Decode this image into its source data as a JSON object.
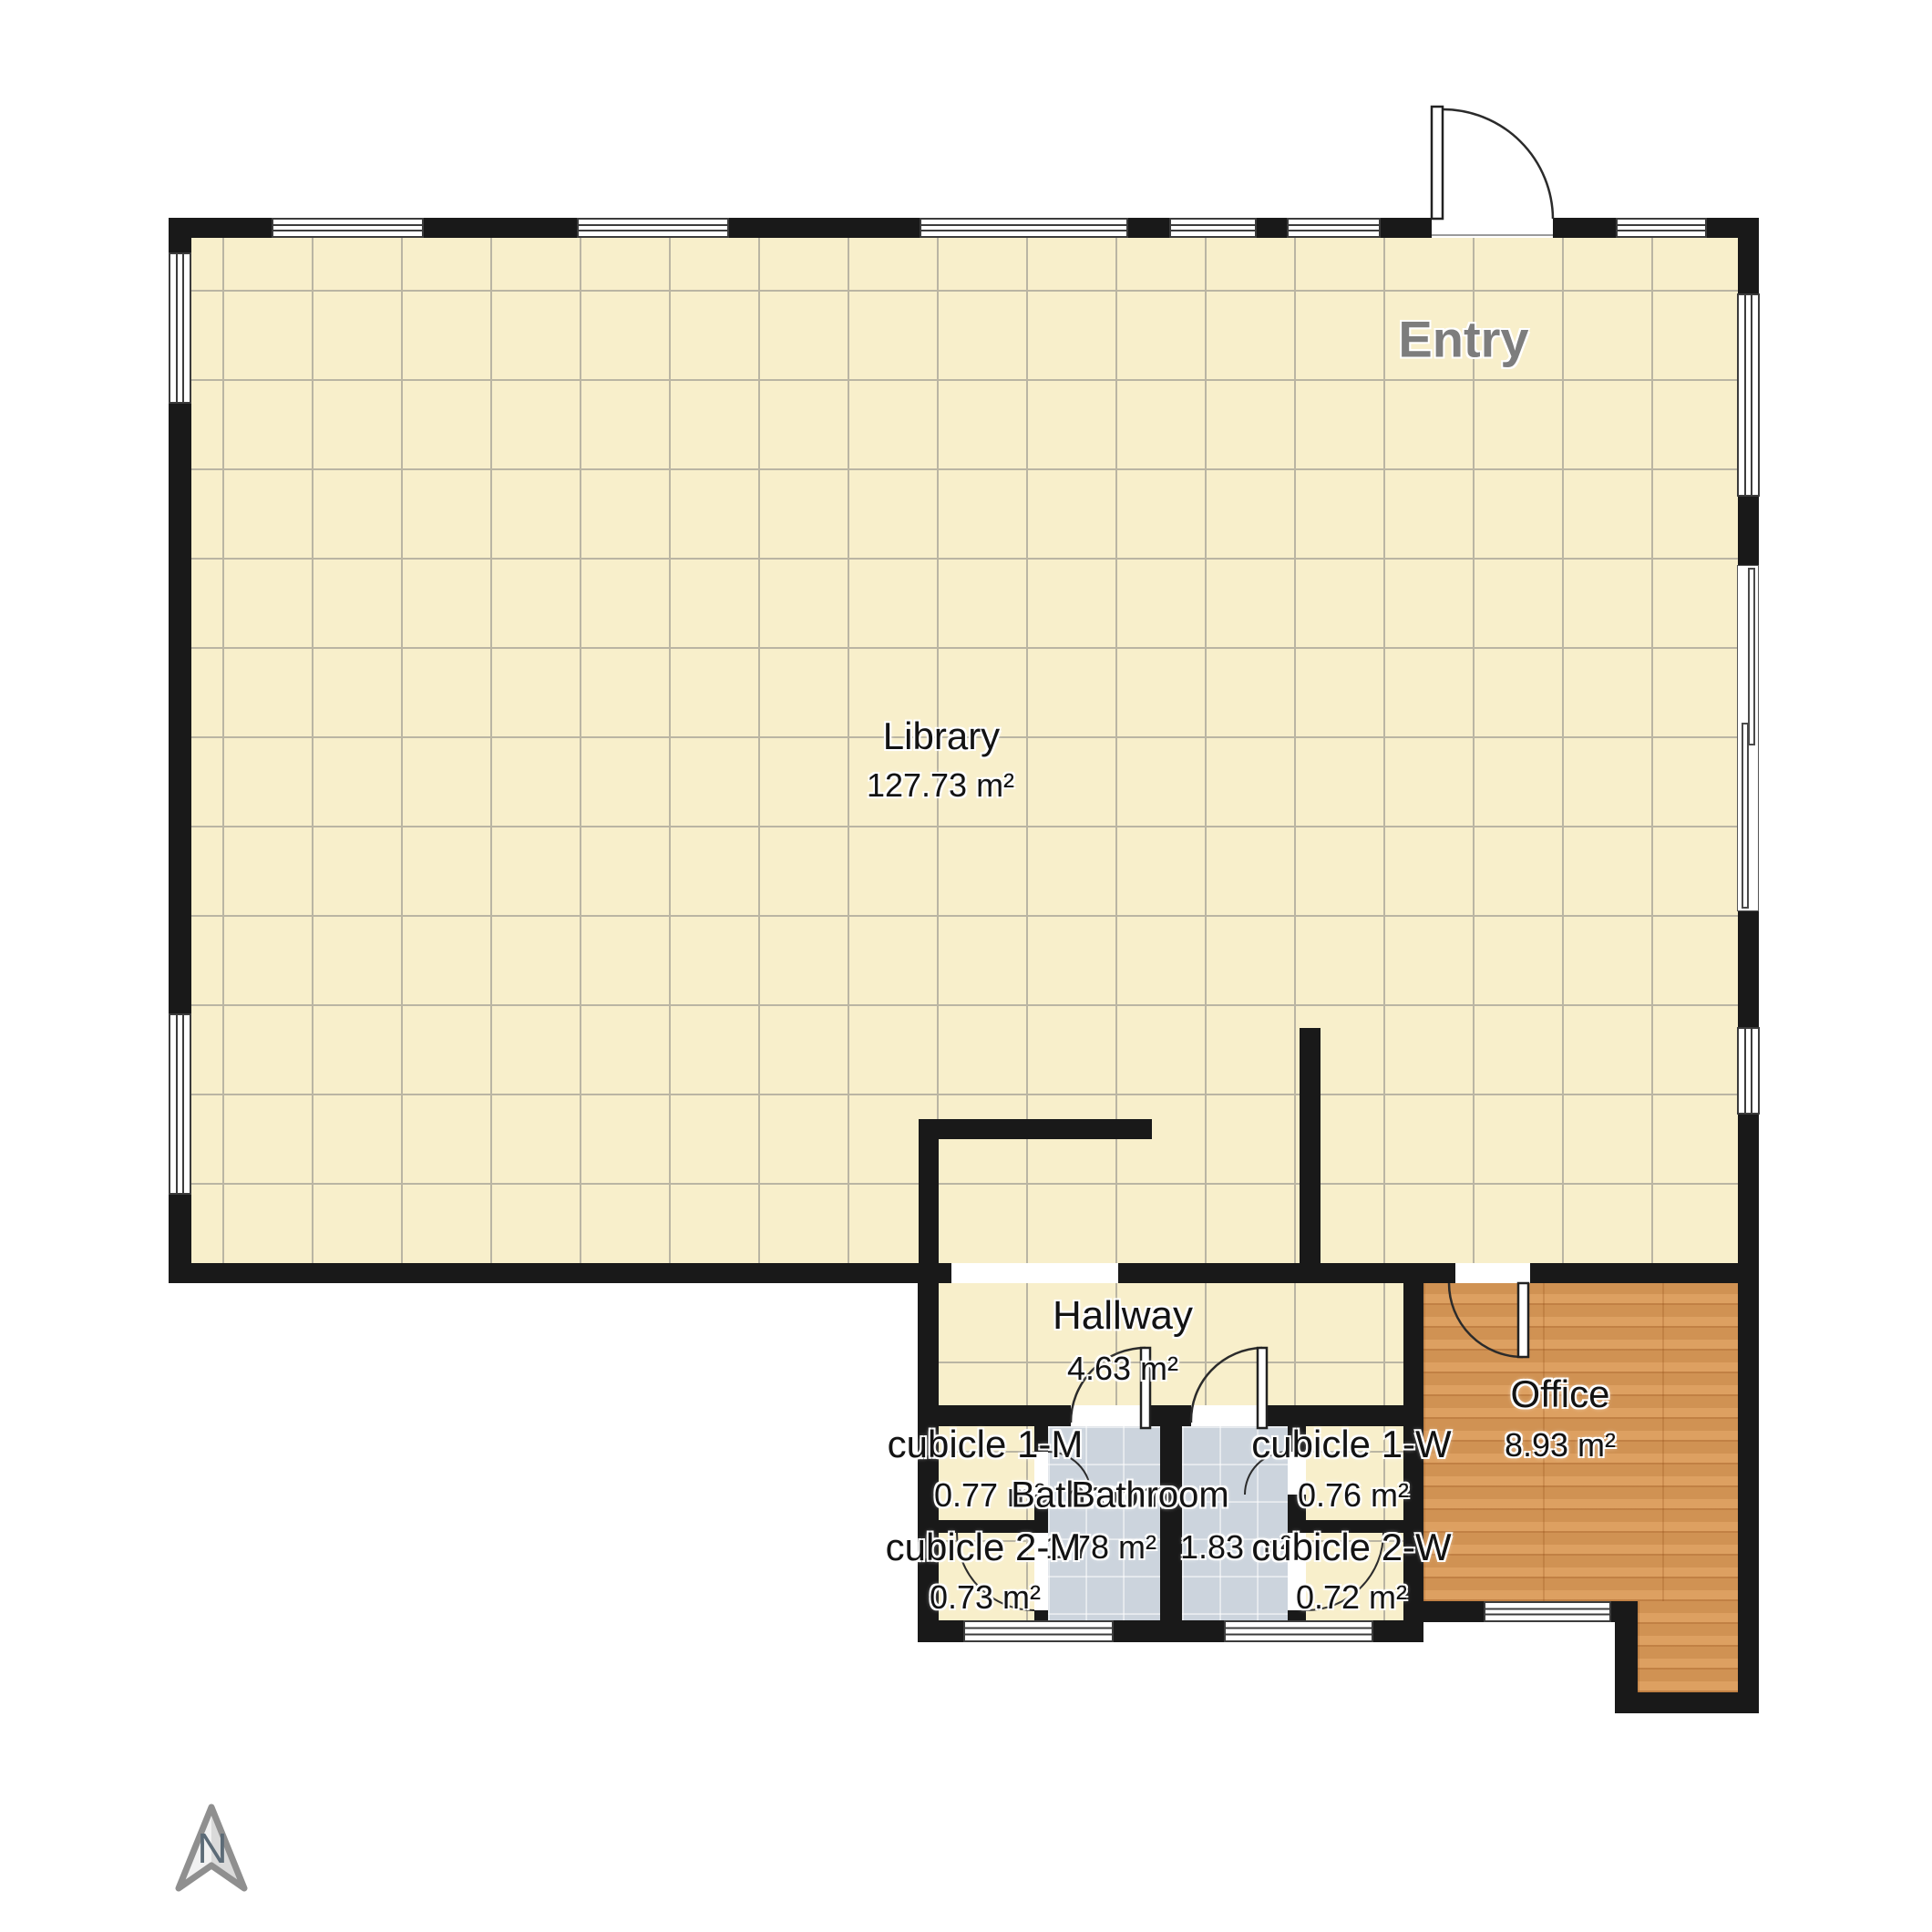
{
  "compass": {
    "label": "N"
  },
  "rooms": {
    "entry": {
      "label": "Entry"
    },
    "library": {
      "label": "Library",
      "area": "127.73 m²"
    },
    "hallway": {
      "label": "Hallway",
      "area": "4.63 m²"
    },
    "office": {
      "label": "Office",
      "area": "8.93 m²"
    },
    "bathroom_m": {
      "label": "Bathroom",
      "area": "1.78 m²"
    },
    "bathroom_w": {
      "label": "Bathroom",
      "area": "1.83 m²"
    },
    "cubicle_1m": {
      "label": "cubicle 1-M",
      "area": "0.77 m²"
    },
    "cubicle_1w": {
      "label": "cubicle 1-W",
      "area": "0.76 m²"
    },
    "cubicle_2m": {
      "label": "cubicle 2-M",
      "area": "0.73 m²"
    },
    "cubicle_2w": {
      "label": "cubicle 2-W",
      "area": "0.72 m²"
    }
  },
  "colors": {
    "wall": "#191919",
    "floor_library": "#f8efcb",
    "floor_grid": "#bab5a3",
    "floor_bathroom": "#ccd4dd",
    "floor_office_wood": "#db9a57",
    "entry_label": "#7d7d7d",
    "label_text": "#131313"
  }
}
